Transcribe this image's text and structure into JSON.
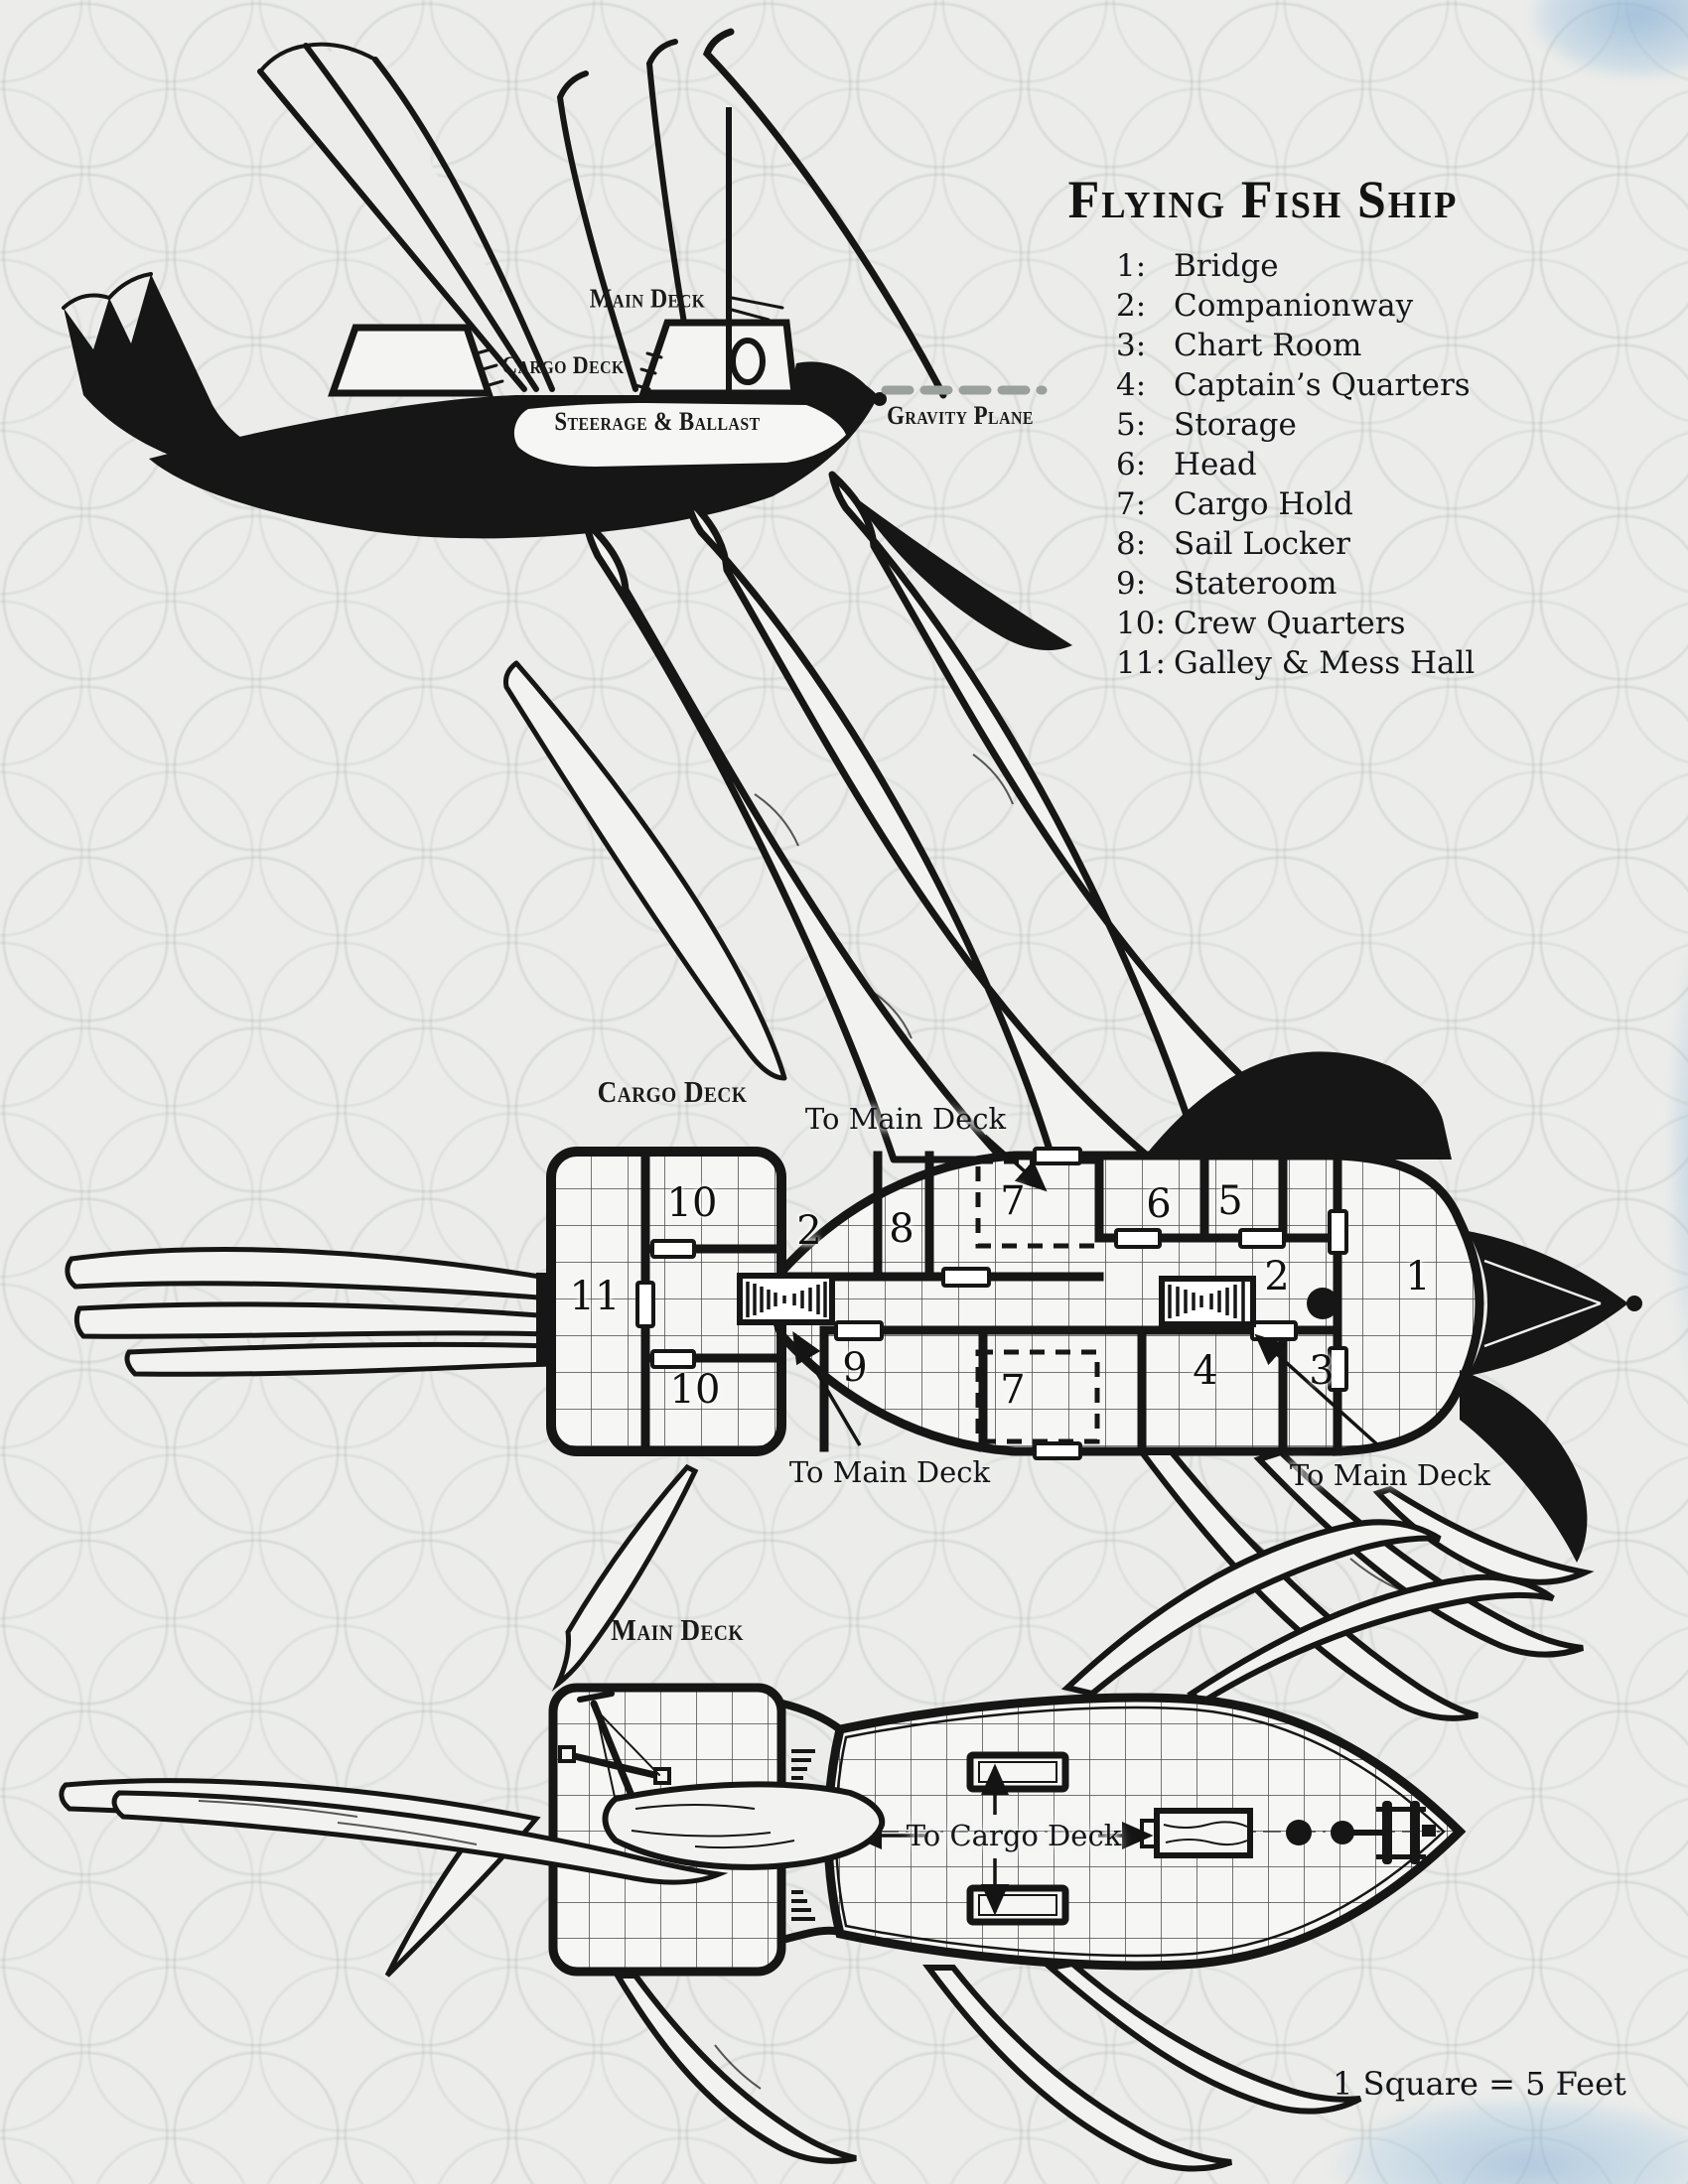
{
  "title": "Flying Fish Ship",
  "scale_note": "1 Square = 5 Feet",
  "colors": {
    "ink": "#161616",
    "paper": "#ecedea",
    "accent_blue": "#a9c7e0",
    "gravity_dash_gray": "#9aa09b"
  },
  "legend": {
    "items": [
      {
        "num": "1:",
        "label": "Bridge"
      },
      {
        "num": "2:",
        "label": "Companionway"
      },
      {
        "num": "3:",
        "label": "Chart Room"
      },
      {
        "num": "4:",
        "label": "Captain’s Quarters"
      },
      {
        "num": "5:",
        "label": "Storage"
      },
      {
        "num": "6:",
        "label": "Head"
      },
      {
        "num": "7:",
        "label": "Cargo Hold"
      },
      {
        "num": "8:",
        "label": "Sail Locker"
      },
      {
        "num": "9:",
        "label": "Stateroom"
      },
      {
        "num": "10:",
        "label": "Crew Quarters"
      },
      {
        "num": "11:",
        "label": "Galley & Mess Hall"
      }
    ]
  },
  "side_view": {
    "main_deck": "Main Deck",
    "cargo_deck": "Cargo Deck",
    "steerage": "Steerage & Ballast",
    "gravity_plane": "Gravity Plane"
  },
  "cargo_deck": {
    "heading": "Cargo Deck",
    "to_main_deck_top": "To Main Deck",
    "to_main_deck_left": "To Main Deck",
    "to_main_deck_right": "To Main Deck",
    "rooms": [
      {
        "n": "10"
      },
      {
        "n": "2"
      },
      {
        "n": "8"
      },
      {
        "n": "7"
      },
      {
        "n": "6"
      },
      {
        "n": "5"
      },
      {
        "n": "2"
      },
      {
        "n": "1"
      },
      {
        "n": "11"
      },
      {
        "n": "9"
      },
      {
        "n": "7"
      },
      {
        "n": "4"
      },
      {
        "n": "3"
      },
      {
        "n": "10"
      }
    ]
  },
  "main_deck": {
    "heading": "Main Deck",
    "to_cargo_deck": "To Cargo Deck"
  }
}
